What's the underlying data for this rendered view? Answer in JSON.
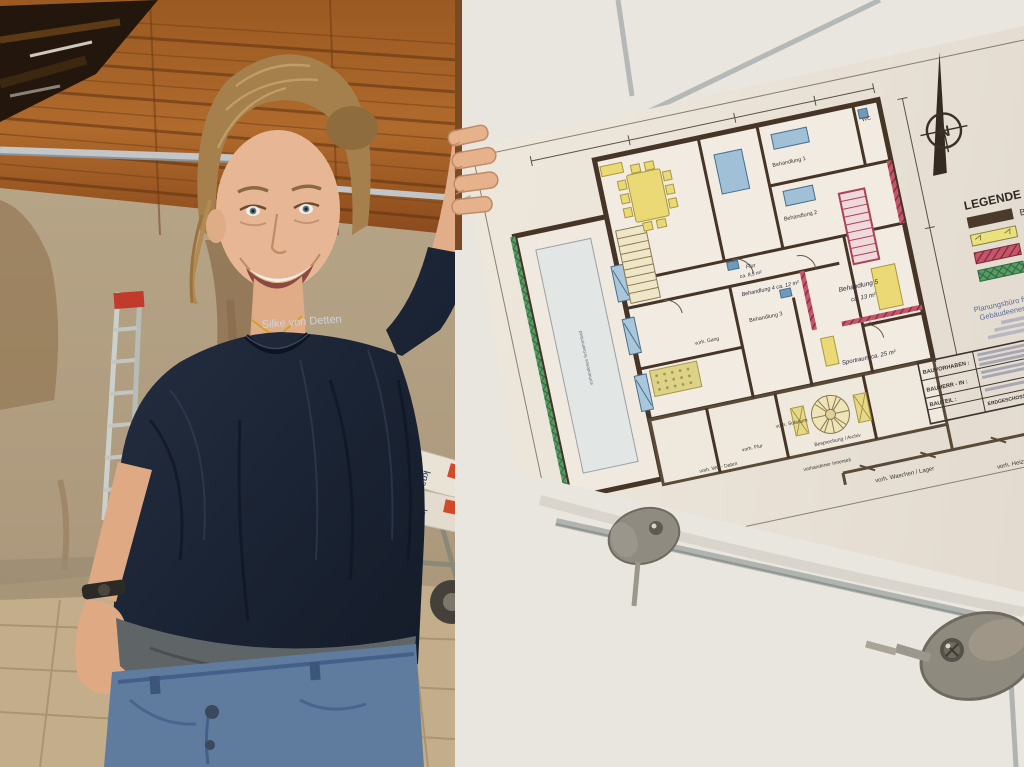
{
  "photo": {
    "person_name_on_shirt": "Silke von Detten",
    "bags_brand": "knauf"
  },
  "floor_plan": {
    "compass_label": "N",
    "legend": {
      "title": "LEGENDE :",
      "items": [
        {
          "label": "Bestand",
          "color": "#4a3a2c",
          "pattern": "solid"
        },
        {
          "label": "Abbruch",
          "color": "#e9e07e",
          "pattern": "solid"
        },
        {
          "label": "Neue Bauteile",
          "color": "#c4556a",
          "pattern": "hatch"
        },
        {
          "label": "Dämmschicht",
          "color": "#5a9a66",
          "pattern": "hatch"
        }
      ]
    },
    "company_block": {
      "line1": "Planungsbüro für Ha…",
      "line2": "Gebäudeenergieberat…"
    },
    "title_block": {
      "rows": [
        {
          "label": "BAUVORHABEN :",
          "value": ""
        },
        {
          "label": "BAUHERR - IN :",
          "value": ""
        },
        {
          "label": "BAUTEIL :",
          "value": "ERDGESCHOSSGRUNDRISS : alternativ"
        }
      ]
    },
    "rooms": [
      {
        "label": "Behandlung 1"
      },
      {
        "label": "Behandlung 2"
      },
      {
        "label": "Behandlung 3"
      },
      {
        "label": "Behandlung 4  ca. 12 m²"
      },
      {
        "label": "Behandlung 5"
      },
      {
        "label": "ca. 13 m²"
      },
      {
        "label": "Flur"
      },
      {
        "label": "ca. 8,5 m²"
      },
      {
        "label": "Sportraum  ca. 25 m²"
      },
      {
        "label": "WC"
      },
      {
        "label": "Speise"
      },
      {
        "label": "vorh. Gang"
      },
      {
        "label": "vorh. Solarium"
      },
      {
        "label": "vorh. Flur"
      },
      {
        "label": "vorh. WC - Daten"
      },
      {
        "label": "Besprechung / Archiv"
      },
      {
        "label": "vorhandener Innenteil"
      },
      {
        "label": "vorh. Waschen /  Lager"
      },
      {
        "label": "vorh. Heizung"
      },
      {
        "label": "vorhandenes Schwimmbad"
      }
    ]
  }
}
